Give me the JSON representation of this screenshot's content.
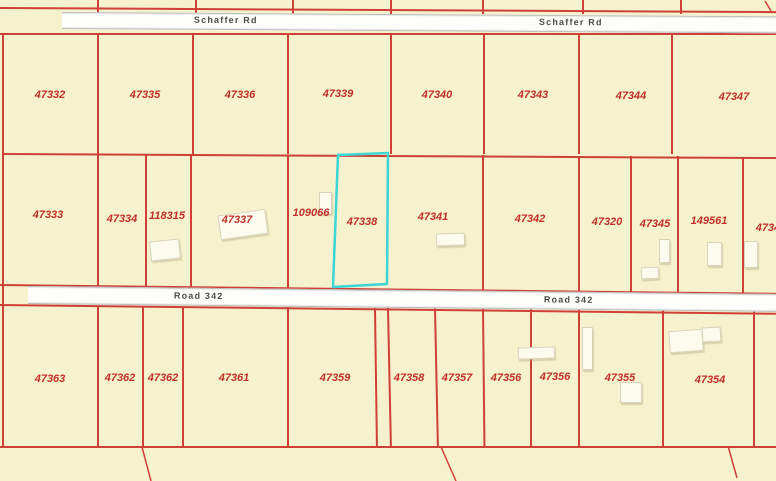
{
  "roads": {
    "schaffer_rd": {
      "label_left": "Schaffer Rd",
      "label_right": "Schaffer Rd"
    },
    "road_342": {
      "label_left": "Road 342",
      "label_right": "Road 342"
    }
  },
  "parcels": {
    "top_row": [
      "47332",
      "47335",
      "47336",
      "47339",
      "47340",
      "47343",
      "47344",
      "47347"
    ],
    "middle_row": [
      "47333",
      "47334",
      "118315",
      "47337",
      "109066",
      "47338",
      "47341",
      "47342",
      "47320",
      "47345",
      "149561",
      "4734"
    ],
    "bottom_row": [
      "47363",
      "47362",
      "47362",
      "47361",
      "47359",
      "47358",
      "47357",
      "47356",
      "47356",
      "47355",
      "47354"
    ]
  },
  "selection": {
    "highlighted_parcel": "47338"
  },
  "colors": {
    "background": "#f6f2cd",
    "parcel_line": "#cf4038",
    "parcel_label": "#c1302a",
    "highlight": "#3dd5d6",
    "road_fill": "#fdfdfb",
    "road_border": "#bdbdbd",
    "road_label": "#4d4d4d",
    "building_fill": "#fdfbee",
    "building_border": "#d8d3ba"
  }
}
